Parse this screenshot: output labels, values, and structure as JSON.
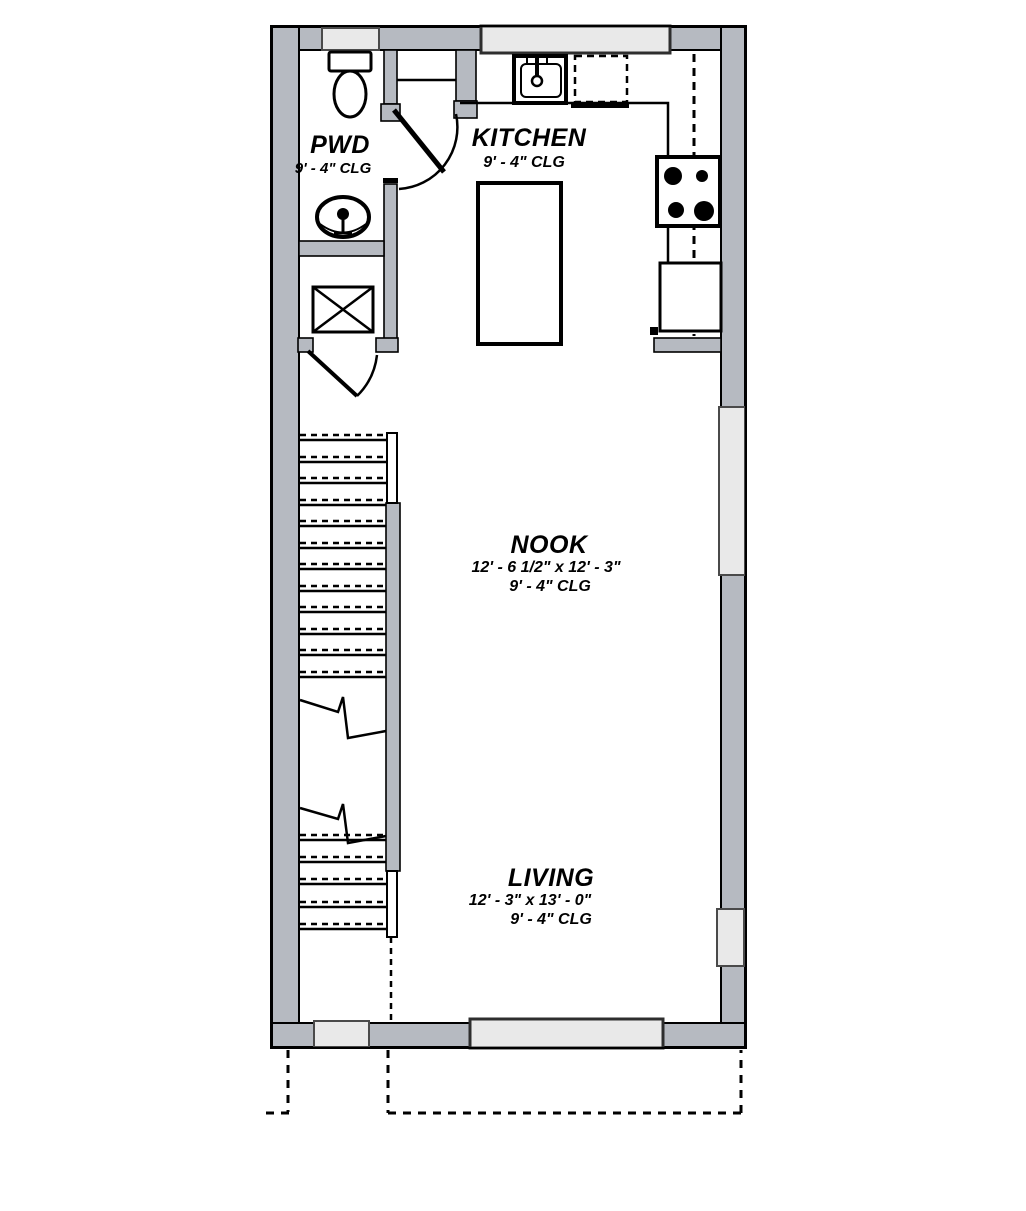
{
  "rooms": {
    "pwd": {
      "name": "PWD",
      "ceiling": "9' - 4\" CLG"
    },
    "kitchen": {
      "name": "KITCHEN",
      "ceiling": "9' - 4\" CLG"
    },
    "nook": {
      "name": "NOOK",
      "dimensions": "12' - 6 1/2\" x 12' - 3\"",
      "ceiling": "9' - 4\" CLG"
    },
    "living": {
      "name": "LIVING",
      "dimensions": "12' - 3\" x 13' - 0\"",
      "ceiling": "9' - 4\" CLG"
    }
  },
  "colors": {
    "wall_fill": "#b6bac1",
    "window_fill": "#e9e9e9",
    "line": "#000000",
    "background": "#ffffff"
  }
}
